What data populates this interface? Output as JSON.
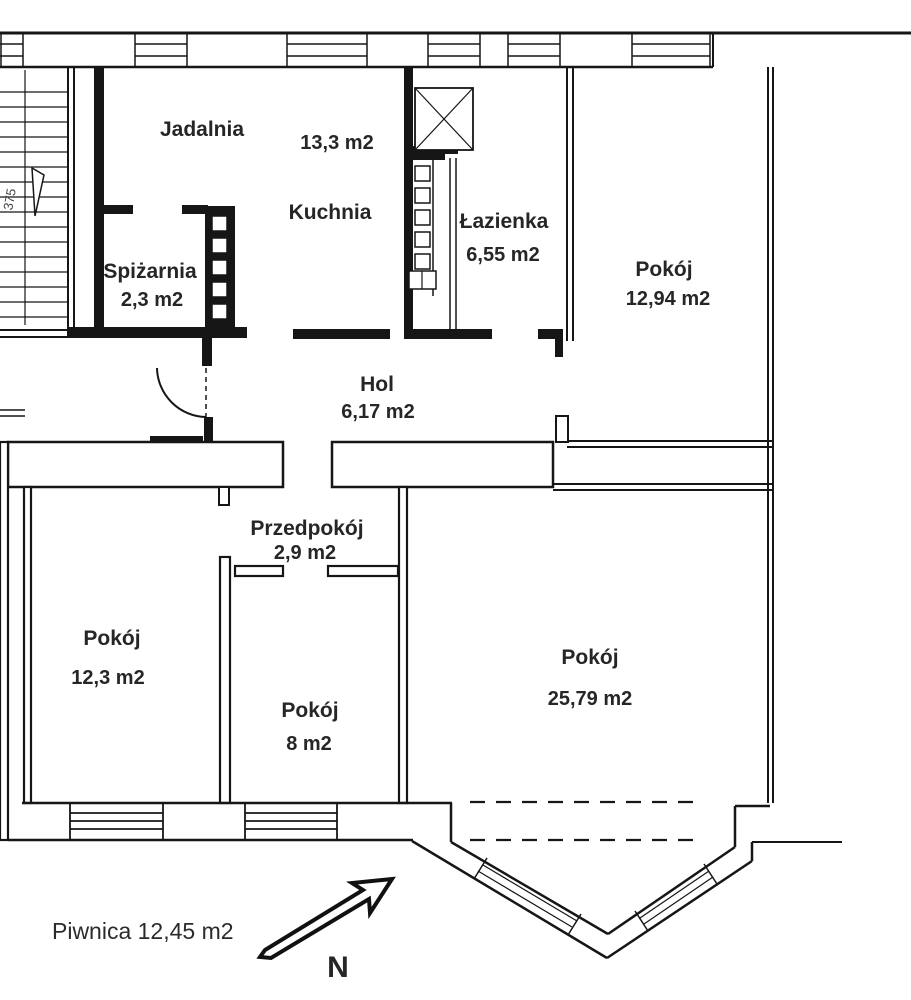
{
  "rooms": {
    "jadalnia": {
      "name": "Jadalnia"
    },
    "kuchnia": {
      "name": "Kuchnia",
      "area": "13,3 m2"
    },
    "lazienka": {
      "name": "Łazienka",
      "area": "6,55 m2"
    },
    "pokoj_polnocny": {
      "name": "Pokój",
      "area": "12,94 m2"
    },
    "spizarnia": {
      "name": "Spiżarnia",
      "area": "2,3 m2"
    },
    "hol": {
      "name": "Hol",
      "area": "6,17 m2"
    },
    "przedpokoj": {
      "name": "Przedpokój",
      "area": "2,9 m2"
    },
    "pokoj_zachodni": {
      "name": "Pokój",
      "area": "12,3 m2"
    },
    "pokoj_srodkowy": {
      "name": "Pokój",
      "area": "8 m2"
    },
    "pokoj_poludniowy": {
      "name": "Pokój",
      "area": "25,79 m2"
    }
  },
  "annotations": {
    "piwnica": "Piwnica 12,45 m2",
    "north_label": "N",
    "stairs_dimension": "375"
  },
  "colors": {
    "wall": "#161616",
    "text": "#262626",
    "background": "#ffffff"
  }
}
